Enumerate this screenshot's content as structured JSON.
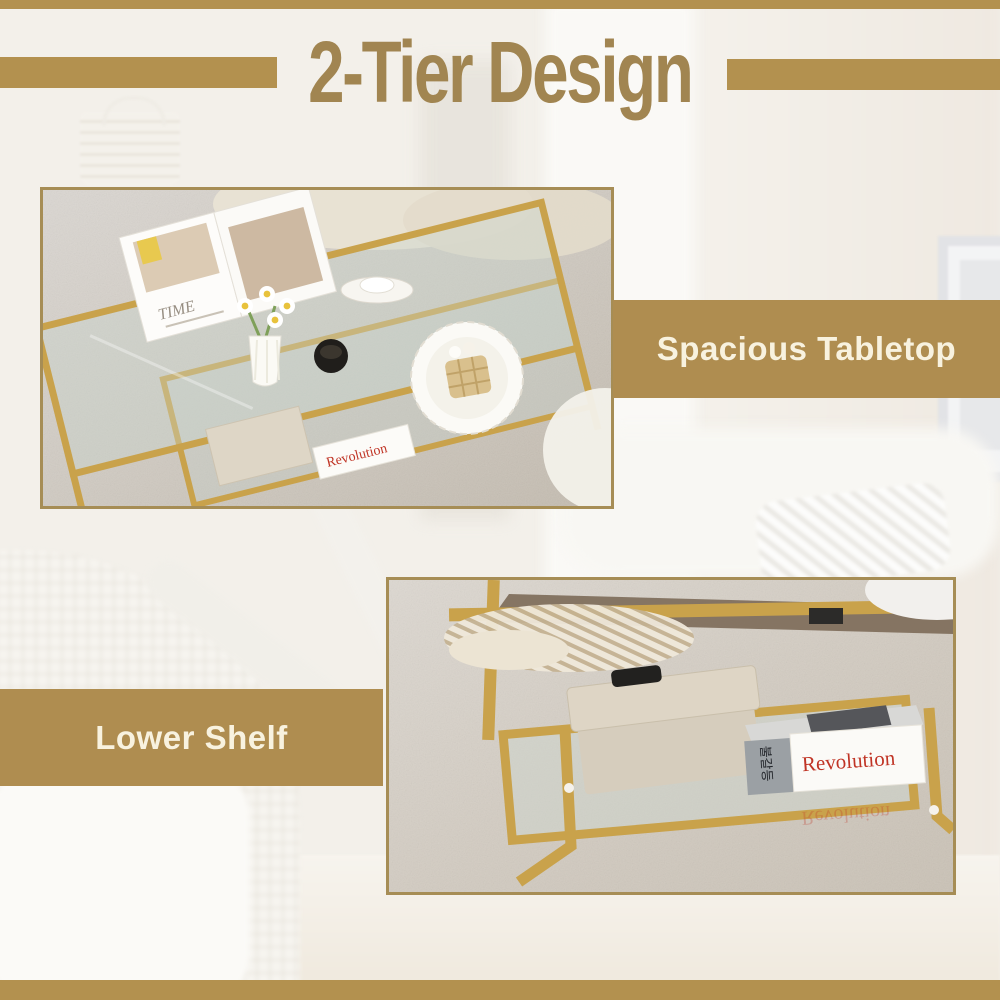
{
  "header": {
    "title": "2-Tier Design"
  },
  "callouts": {
    "tabletop_label": "Spacious Tabletop",
    "shelf_label": "Lower Shelf"
  },
  "photo_top": {
    "magazine_title": "TIME",
    "book_title": "Revolution"
  },
  "photo_bottom": {
    "book_title": "Revolution",
    "book_spine_glyphs": "불갈등"
  },
  "colors": {
    "gold_accent": "#B3914F",
    "band_background": "#AF8D50",
    "band_text": "#F8F2DF",
    "title_text": "#A18551",
    "photo_border": "#A68D55",
    "frame_gold": "#C9A24B",
    "book_text_red": "#C03425"
  }
}
